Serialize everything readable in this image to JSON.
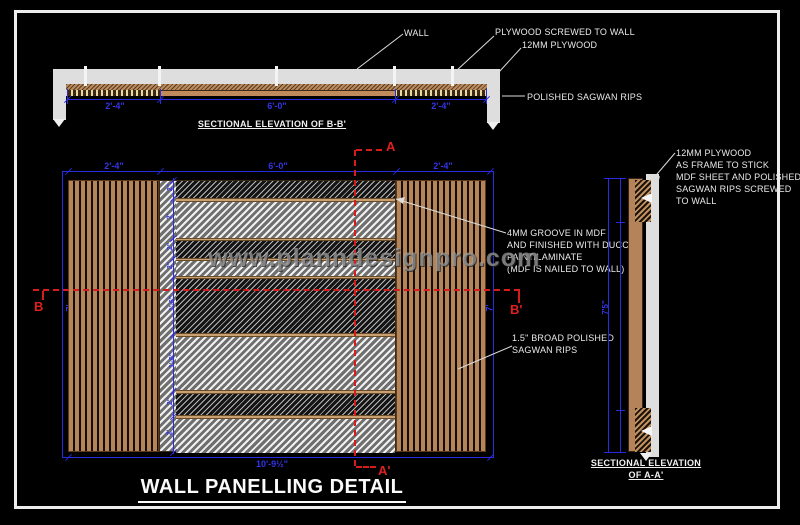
{
  "title": "WALL PANELLING DETAIL",
  "watermark": "www.planndesignpro.com",
  "colors": {
    "background": "#000000",
    "frame": "#ededed",
    "dimension_blue": "#2a2ae0",
    "marker_red": "#d81c1c",
    "wood_tan": "#b5835a",
    "wall_gray": "#dedede",
    "text_white": "#e9e9e9"
  },
  "top_section": {
    "caption": "SECTIONAL ELEVATION OF B-B'",
    "dims": {
      "left": "2'-4\"",
      "middle": "6'-0\"",
      "right": "2'-4\""
    },
    "labels": {
      "wall": "WALL",
      "plywood_screwed": "PLYWOOD SCREWED TO WALL",
      "plywood_12mm": "12MM PLYWOOD",
      "polished_rips": "POLISHED SAGWAN RIPS"
    }
  },
  "elevation": {
    "dims": {
      "top_left": "2'-4\"",
      "top_middle": "6'-0\"",
      "top_right": "2'-4\"",
      "bottom_total": "10'-9½\"",
      "height_left": "7'",
      "height_right": "7'"
    },
    "segment_dims": [
      "2\"",
      "2'",
      "2\"",
      "2\"",
      "1'-6\"",
      "1'-6\"",
      "2\"",
      "2'"
    ],
    "markers": {
      "a_top": "A",
      "a_bottom": "A'",
      "b_left": "B",
      "b_right": "B'"
    },
    "notes": {
      "groove": [
        "4MM GROOVE IN MDF",
        "AND FINISHED WITH DUCCO",
        "PAINT/LAMINATE",
        "(MDF IS NAILED TO WALL)"
      ],
      "rips": [
        "1.5\" BROAD POLISHED",
        "SAGWAN RIPS"
      ]
    }
  },
  "side_section": {
    "caption": [
      "SECTIONAL ELEVATION",
      "OF A-A'"
    ],
    "dim_height": "7'5\"",
    "note": [
      "12MM PLYWOOD",
      "AS FRAME TO STICK",
      "MDF SHEET AND POLISHED",
      "SAGWAN RIPS SCREWED",
      "TO WALL"
    ]
  }
}
